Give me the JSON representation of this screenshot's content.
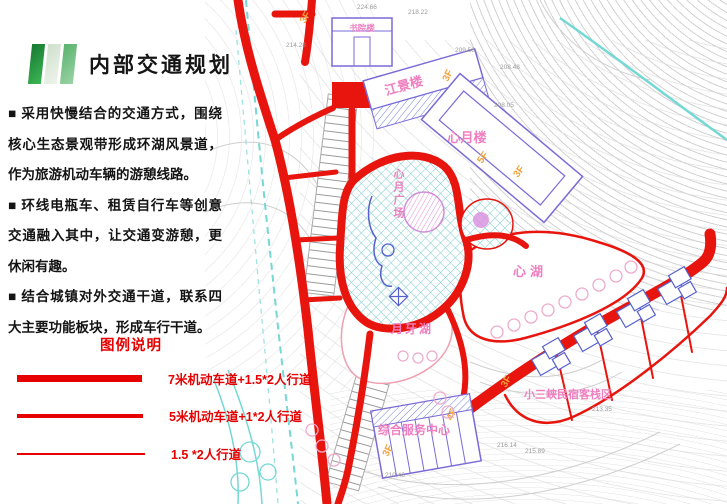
{
  "slide": {
    "title": "内部交通规划",
    "bullets": [
      "■ 采用快慢结合的交通方式，围绕核心生态景观带形成环湖风景道，作为旅游机动车辆的游憩线路。",
      "■ 环线电瓶车、租赁自行车等创意交通融入其中，让交通变游憩，更休闲有趣。",
      "■ 结合城镇对外交通干道，联系四大主要功能板块，形成车行干道。"
    ],
    "legend": {
      "title": "图例说明",
      "items": [
        {
          "label": "7米机动车道+1.5*2人行道",
          "line_weight_px": 7
        },
        {
          "label": "5米机动车道+1*2人行道",
          "line_weight_px": 4
        },
        {
          "label": "1.5 *2人行道",
          "line_weight_px": 2
        }
      ]
    }
  },
  "map": {
    "labels": {
      "shuyuanlou": "书院楼",
      "jiangjinglou": "江景楼",
      "xinyuelou": "心月楼",
      "plaza": "心月广场",
      "xinhu": "心湖",
      "yueyahu": "月牙湖",
      "service_center": "综合服务中心",
      "homestay_area": "小三峡民宿客栈区"
    },
    "floors": {
      "shuyuanlou": "3F",
      "jiangjinglou": "3F",
      "xinyuelou_5f": "5F",
      "xinyuelou_3f": "3F",
      "service_4f": "4F",
      "service_3f": "3F",
      "homestay_3f": "3F"
    },
    "elevations": [
      "224.66",
      "218.22",
      "214.28",
      "209.58",
      "208.48",
      "208.05",
      "213.35",
      "210.46",
      "216.14",
      "215.89"
    ],
    "colors": {
      "road_red": "#e8150e",
      "legend_red": "#e60000",
      "label_pink": "#f07fc0",
      "floor_orange": "#f2a23c",
      "building_purple": "#7a6ad8",
      "hatch_teal": "#7ecccc",
      "stream_cyan": "#74d8d4",
      "contour_gray": "#c9c9c9"
    }
  }
}
